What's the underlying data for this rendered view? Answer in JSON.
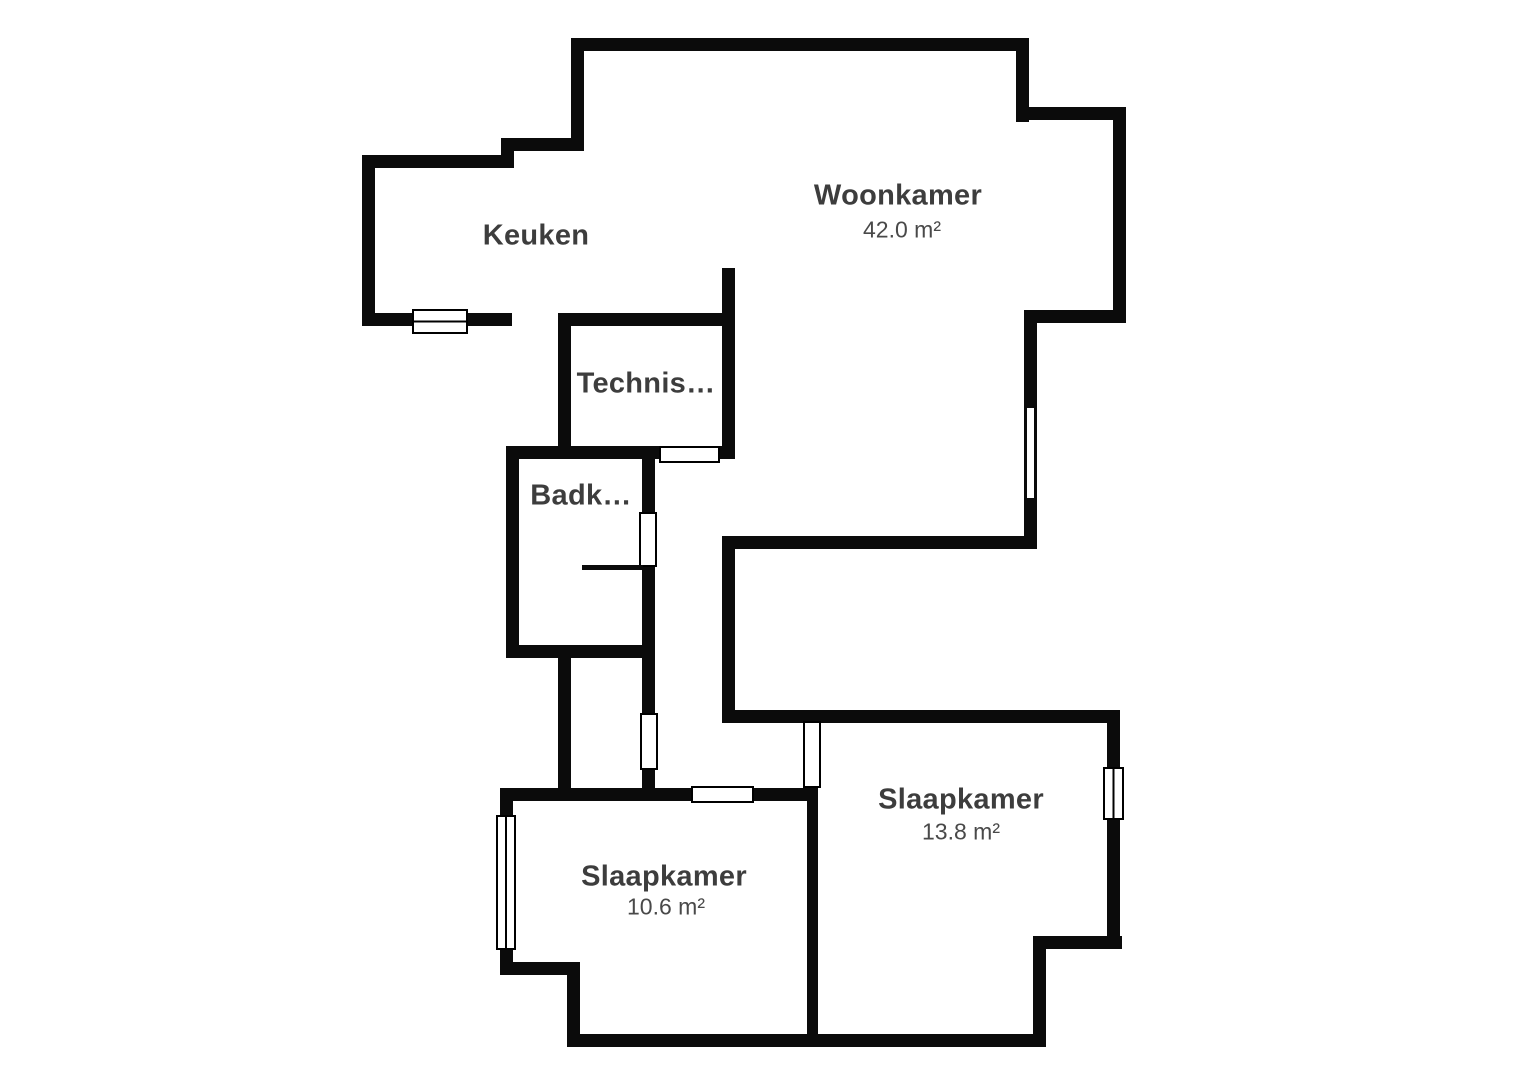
{
  "floorplan": {
    "canvas": {
      "width": 1527,
      "height": 1080,
      "background": "#ffffff"
    },
    "style": {
      "wall_color": "#0b0b0b",
      "room_name_color": "#3d3d3d",
      "room_area_color": "#494949",
      "opening_fill": "#ffffff",
      "opening_border": "#000000"
    },
    "rooms": [
      {
        "id": "keuken",
        "name": "Keuken",
        "cx": 536,
        "cy": 236
      },
      {
        "id": "woonkamer",
        "name": "Woonkamer",
        "cx": 898,
        "cy": 196,
        "area": "42.0 m²",
        "area_cx": 902,
        "area_cy": 230
      },
      {
        "id": "technische-ruimte",
        "name": "Technis…",
        "cx": 646,
        "cy": 384
      },
      {
        "id": "badkamer",
        "name": "Badk…",
        "cx": 581,
        "cy": 496
      },
      {
        "id": "slaapkamer-rechts",
        "name": "Slaapkamer",
        "cx": 961,
        "cy": 800,
        "area": "13.8 m²",
        "area_cx": 961,
        "area_cy": 832
      },
      {
        "id": "slaapkamer-links",
        "name": "Slaapkamer",
        "cx": 664,
        "cy": 877,
        "area": "10.6 m²",
        "area_cx": 666,
        "area_cy": 907
      }
    ],
    "walls": [
      [
        571,
        38,
        458,
        13
      ],
      [
        571,
        38,
        13,
        113
      ],
      [
        501,
        138,
        82,
        13
      ],
      [
        501,
        138,
        13,
        30
      ],
      [
        362,
        155,
        151,
        13
      ],
      [
        362,
        155,
        13,
        171
      ],
      [
        362,
        313,
        150,
        13
      ],
      [
        558,
        313,
        175,
        13
      ],
      [
        558,
        313,
        13,
        146
      ],
      [
        722,
        268,
        13,
        191
      ],
      [
        506,
        446,
        227,
        13
      ],
      [
        506,
        446,
        13,
        212
      ],
      [
        642,
        446,
        13,
        344
      ],
      [
        506,
        645,
        142,
        13
      ],
      [
        558,
        645,
        13,
        145
      ],
      [
        500,
        788,
        318,
        13
      ],
      [
        500,
        788,
        13,
        187
      ],
      [
        500,
        962,
        80,
        13
      ],
      [
        567,
        962,
        13,
        85
      ],
      [
        567,
        1034,
        479,
        13
      ],
      [
        807,
        710,
        11,
        337
      ],
      [
        722,
        710,
        398,
        13
      ],
      [
        722,
        536,
        13,
        187
      ],
      [
        722,
        536,
        315,
        13
      ],
      [
        1024,
        310,
        13,
        239
      ],
      [
        1024,
        310,
        102,
        13
      ],
      [
        1113,
        107,
        13,
        216
      ],
      [
        1016,
        107,
        110,
        13
      ],
      [
        1016,
        38,
        13,
        84
      ],
      [
        1107,
        710,
        13,
        239
      ],
      [
        1033,
        936,
        89,
        13
      ],
      [
        1033,
        936,
        13,
        111
      ]
    ],
    "windows": [
      {
        "name": "keuken-window",
        "x": 413,
        "y": 310,
        "w": 54,
        "h": 23,
        "divider": "h"
      },
      {
        "name": "slaapkamer-links-window",
        "x": 497,
        "y": 816,
        "w": 18,
        "h": 133,
        "divider": "v"
      },
      {
        "name": "slaapkamer-rechts-window",
        "x": 1104,
        "y": 768,
        "w": 19,
        "h": 51,
        "divider": "v"
      },
      {
        "name": "woonkamer-window",
        "x": 1027,
        "y": 408,
        "w": 7,
        "h": 90,
        "slit": true
      }
    ],
    "doors": [
      {
        "name": "technische-ruimte-door",
        "x": 660,
        "y": 447,
        "w": 59,
        "h": 15
      },
      {
        "name": "badkamer-door",
        "x": 640,
        "y": 513,
        "w": 16,
        "h": 53
      },
      {
        "name": "hal-door",
        "x": 641,
        "y": 714,
        "w": 16,
        "h": 55
      },
      {
        "name": "slaapkamer-links-door",
        "x": 692,
        "y": 787,
        "w": 61,
        "h": 15
      },
      {
        "name": "slaapkamer-rechts-door",
        "x": 804,
        "y": 722,
        "w": 16,
        "h": 65
      }
    ],
    "partitions": [
      {
        "name": "badkamer-partition-line",
        "x": 582,
        "y": 565,
        "w": 61,
        "h": 5
      }
    ]
  }
}
